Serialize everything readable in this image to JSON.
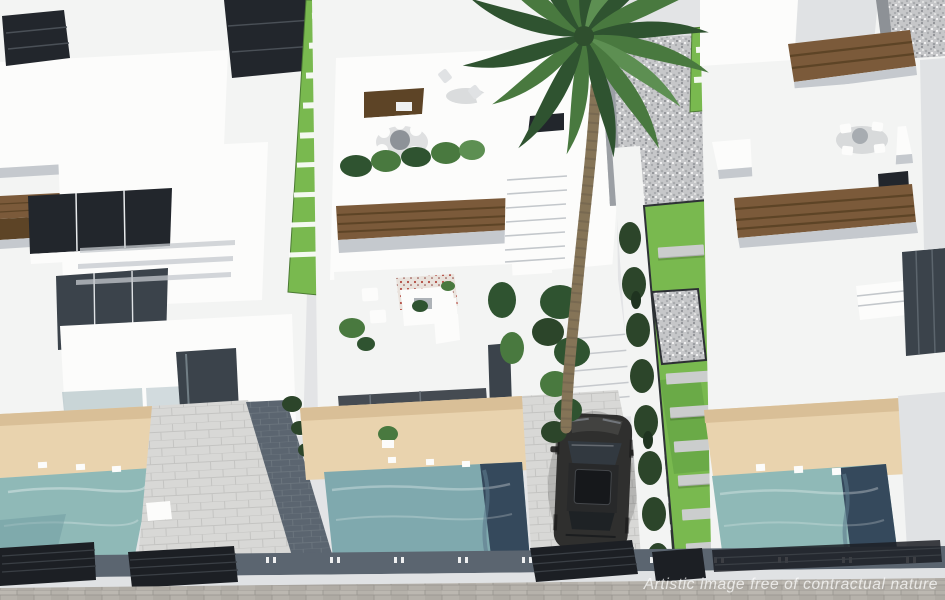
{
  "meta": {
    "type": "3d-architectural-render",
    "view": "aerial",
    "subject": "row of modern white villas with private pools, rooftop terraces, palm tree and parked car"
  },
  "watermark": {
    "text": "Artistic image free of contractual nature"
  },
  "palette": {
    "base": "#e3e4e6",
    "white_sun": "#f3f4f3",
    "white_bright": "#fcfcfb",
    "white_shade": "#e0e2e4",
    "wall_shadow": "#c5c9ce",
    "dark_window": "#22262c",
    "glass_dark": "#3b434b",
    "wood": "#7b5a3a",
    "wood_dark": "#5d4426",
    "grass_bright": "#79b94f",
    "grass_mid": "#5f9e41",
    "hedge_dark": "#2c452a",
    "palm_green": "#49793f",
    "palm_dark": "#2f5330",
    "trunk": "#857457",
    "pool_left": "#8fb9b7",
    "pool_mid": "#7fa9ae",
    "pool_dark": "#35495c",
    "deck_beige": "#e9d3ae",
    "deck_beige_shade": "#d9bf97",
    "paver_light": "#d8d8d6",
    "paver_blue_dark": "#5b6570",
    "gravel": "#c6c7c9",
    "sidewalk": "#b6b2ab",
    "fence_dark": "#1c1f24",
    "car_body": "#2f2f2e",
    "watermark": "rgba(255,255,255,0.72)"
  },
  "scene": {
    "objects": [
      "left-villa",
      "center-villa",
      "right-villa",
      "center-roof-terrace",
      "center-mid-terrace",
      "left-pool",
      "center-pool",
      "right-pool",
      "beige-sun-decks",
      "driveways",
      "parked-car",
      "hedge-row",
      "palm-tree",
      "cypress-hedge",
      "garden-stepping-stones",
      "grass-strips",
      "gravel-paths",
      "street-wall",
      "boundary-fence-gates",
      "brick-sidewalk",
      "watermark-text"
    ]
  }
}
